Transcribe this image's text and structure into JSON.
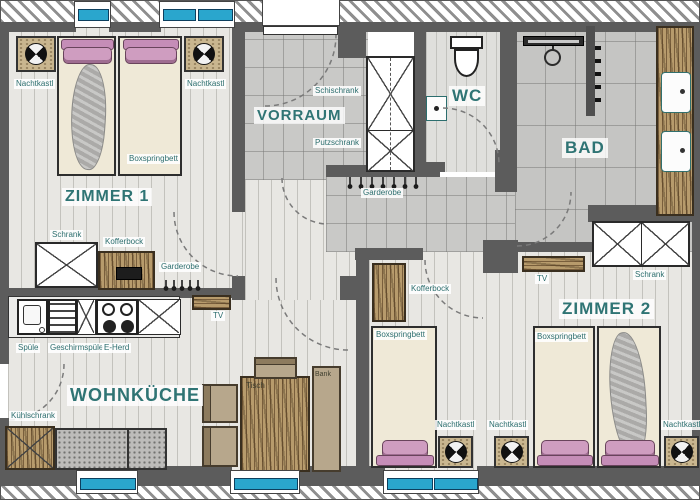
{
  "plan": {
    "rooms": {
      "zimmer1": "ZIMMER 1",
      "vorraum": "VORRAUM",
      "wc": "WC",
      "bad": "BAD",
      "zimmer2": "ZIMMER 2",
      "wohnkueche": "WOHNKÜCHE"
    },
    "labels": {
      "nachtkastl": "Nachtkastl",
      "boxspringbett": "Boxspringbett",
      "schrank": "Schrank",
      "kofferbock": "Kofferbock",
      "garderobe": "Garderobe",
      "schischrank": "Schischrank",
      "putzschrank": "Putzschrank",
      "spuele": "Spüle",
      "geschirrspueler": "Geschirmspüler",
      "eherd": "E-Herd",
      "kuehlschrank": "Kühlschrank",
      "tv": "TV",
      "tisch": "Tisch",
      "bank": "Bank"
    },
    "colors": {
      "room_label": "#2f7474",
      "window_glass": "#2aa6cd",
      "wall": "#5c5c5c",
      "wood": "#b79b6c",
      "pillow_pink": "#cf9dc0"
    }
  }
}
